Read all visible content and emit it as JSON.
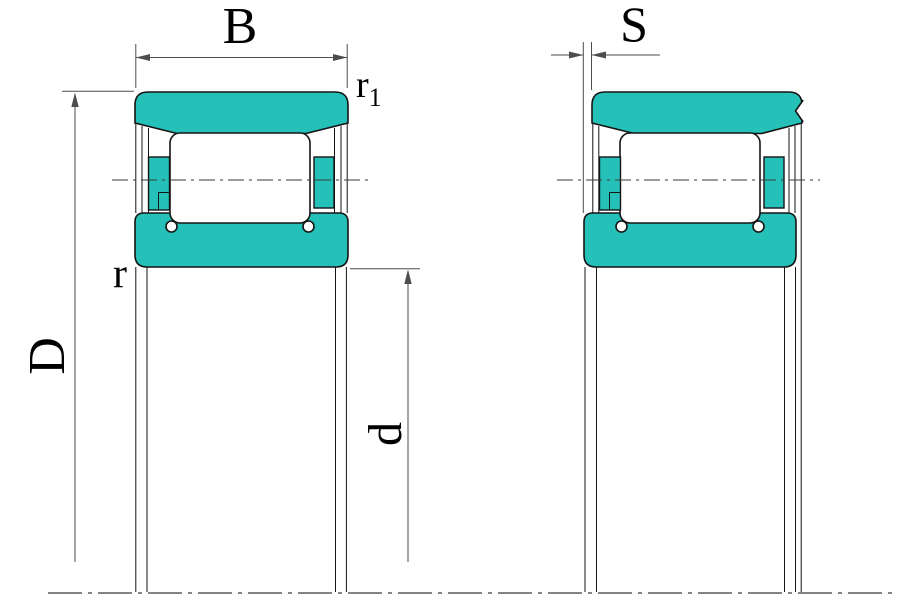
{
  "diagram": {
    "labels": {
      "B": "B",
      "S": "S",
      "D": "D",
      "d": "d",
      "r": "r",
      "r1_base": "r",
      "r1_sub": "1"
    },
    "colors": {
      "ring_fill": "#25c1b9",
      "outline": "#141414",
      "dim_line": "#4d4d4d",
      "centerline": "#3a3a3a",
      "background": "#ffffff"
    }
  }
}
